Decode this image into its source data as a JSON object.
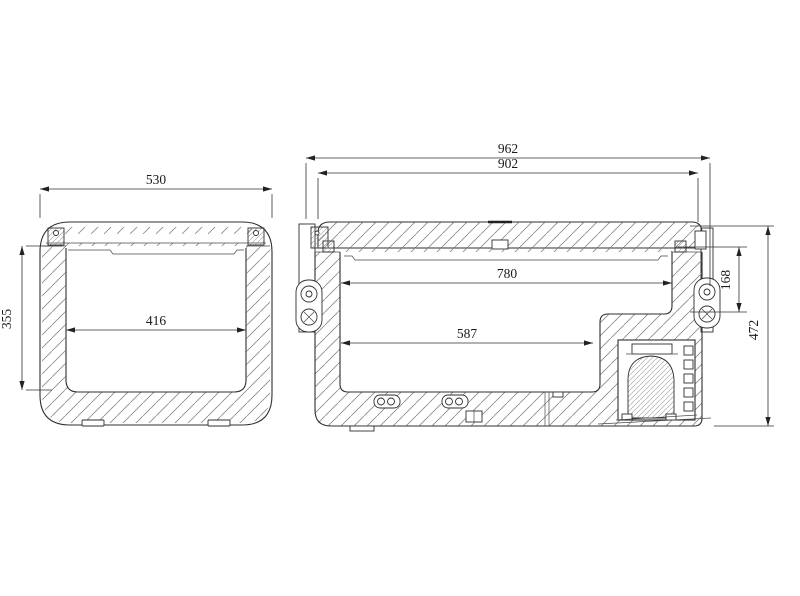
{
  "colors": {
    "background": "#ffffff"
  },
  "views": {
    "front": {
      "overall_width": "530",
      "inner_width": "416",
      "inner_depth": "355"
    },
    "side": {
      "overall_length": "962",
      "lid_length": "902",
      "inner_length_top": "780",
      "inner_length_base": "587",
      "step_depth": "168",
      "overall_height": "472"
    }
  }
}
